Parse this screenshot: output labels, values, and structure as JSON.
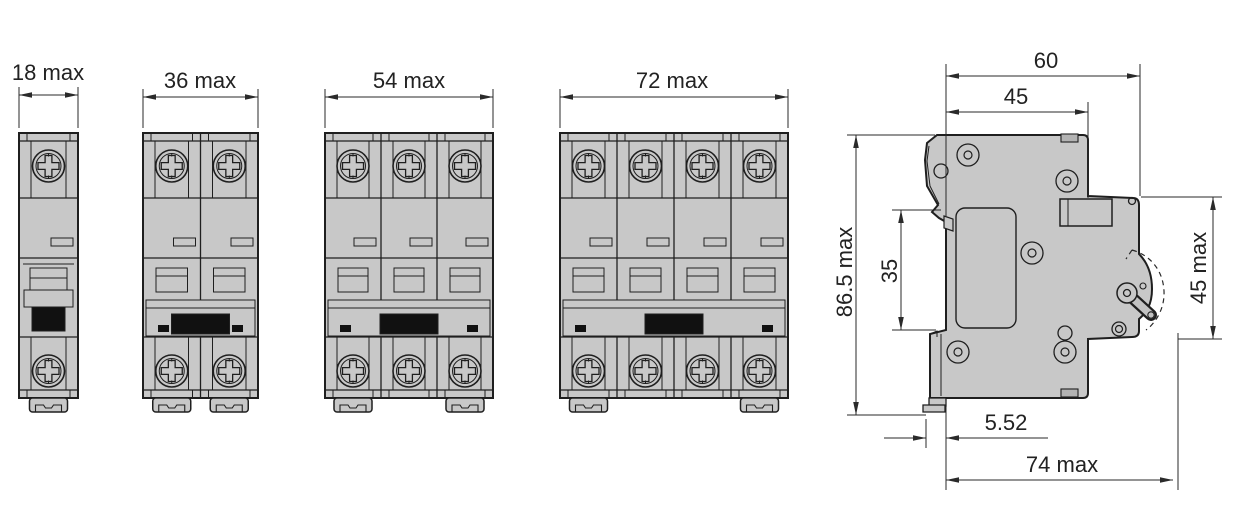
{
  "drawing": {
    "kind": "technical-dimension-drawing",
    "subject": "DIN-rail miniature circuit breakers: front views and side profile",
    "colors": {
      "background": "#ffffff",
      "body_fill": "#c8c8c8",
      "tab_fill": "#b3b3b3",
      "lever_fill": "#c2c2c2",
      "outline": "#1f1f1f",
      "toggle_fill": "#111111",
      "dimension": "#2a2a2a"
    },
    "front_views": [
      {
        "name": "1-pole breaker front view",
        "poles": 1,
        "width_label": "18 max"
      },
      {
        "name": "2-pole breaker front view",
        "poles": 2,
        "width_label": "36 max"
      },
      {
        "name": "3-pole breaker front view",
        "poles": 3,
        "width_label": "54 max"
      },
      {
        "name": "4-pole breaker front view",
        "poles": 4,
        "width_label": "72 max"
      }
    ],
    "side_view": {
      "name": "side profile with DIN-rail mount and toggle travel arc",
      "dims": {
        "depth_body": "60",
        "depth_to_step": "45",
        "height_overall": "86.5 max",
        "din_rail": "35",
        "front_face_height": "45 max",
        "clip_protrusion": "5.52",
        "depth_with_toggle": "74 max"
      }
    }
  }
}
